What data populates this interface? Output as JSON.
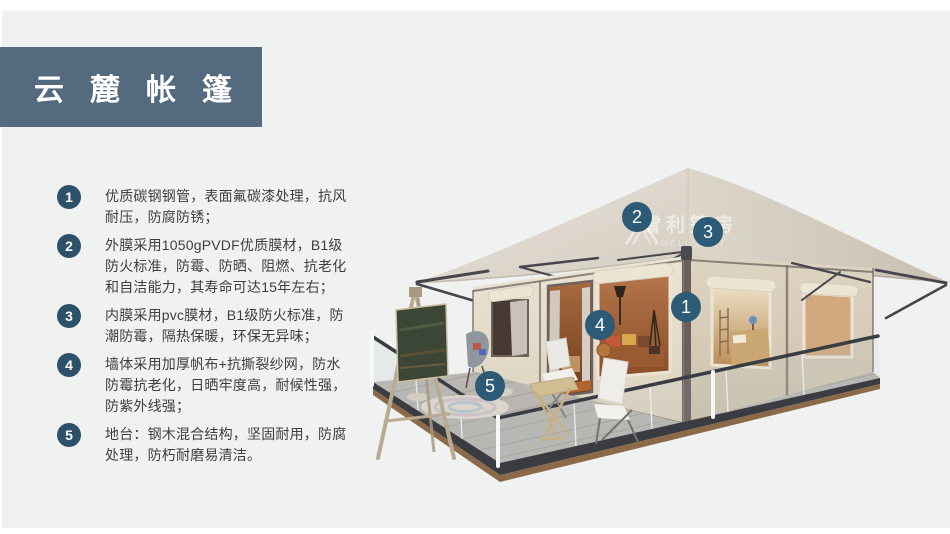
{
  "header": {
    "title": "云麓帐篷",
    "banner_color": "#546a7e",
    "title_color": "#ffffff"
  },
  "features": {
    "badge_color": "#2d5169",
    "text_color": "#3e3e3e",
    "items": [
      {
        "num": "1",
        "text": "优质碳钢钢管，表面氟碳漆处理，抗风耐压，防腐防锈；"
      },
      {
        "num": "2",
        "text": "外膜采用1050gPVDF优质膜材，B1级防火标准，防霉、防晒、阻燃、抗老化和自洁能力，其寿命可达15年左右；"
      },
      {
        "num": "3",
        "text": "内膜采用pvc膜材，B1级防火标准，防潮防霉，隔热保暖，环保无异味；"
      },
      {
        "num": "4",
        "text": "墙体采用加厚帆布+抗撕裂纱网，防水防霉抗老化，日晒牢度高，耐候性强，防紫外线强；"
      },
      {
        "num": "5",
        "text": "地台：钢木混合结构，坚固耐用，防腐处理，防朽耐磨易清洁。"
      }
    ]
  },
  "tent": {
    "marker_color": "#2d5b75",
    "markers": [
      {
        "label": "1"
      },
      {
        "label": "2"
      },
      {
        "label": "3"
      },
      {
        "label": "4"
      },
      {
        "label": "5"
      }
    ],
    "watermark": {
      "text": "雪利篷房",
      "subtext": "YUELI TENT"
    },
    "colors": {
      "roof": "#d9d2c6",
      "wall_front": "#e6dfcf",
      "wall_side": "#d9cfbd",
      "trim": "#6e625e",
      "deck": "#b9b6b1",
      "base_wood": "#8a6a48",
      "interior_warm": "#a96a3d"
    }
  }
}
